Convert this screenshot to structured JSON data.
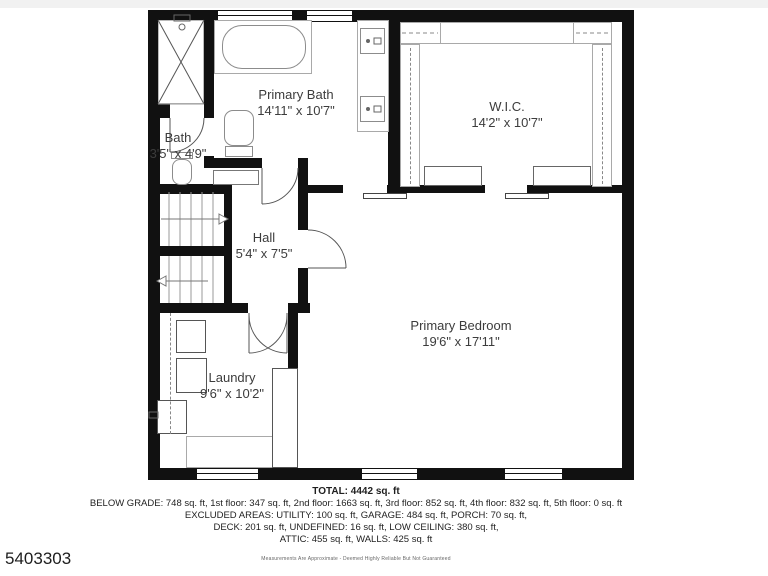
{
  "page": {
    "mls_number": "5403303"
  },
  "rooms": {
    "primary_bath": {
      "name": "Primary Bath",
      "dims": "14'11\" x 10'7\""
    },
    "bath": {
      "name": "Bath",
      "dims": "3'5\" x 4'9\""
    },
    "wic": {
      "name": "W.I.C.",
      "dims": "14'2\" x 10'7\""
    },
    "hall": {
      "name": "Hall",
      "dims": "5'4\" x 7'5\""
    },
    "primary_bedroom": {
      "name": "Primary Bedroom",
      "dims": "19'6\" x 17'11\""
    },
    "laundry": {
      "name": "Laundry",
      "dims": "9'6\" x 10'2\""
    }
  },
  "summary": {
    "total": "TOTAL: 4442 sq. ft",
    "line1": "BELOW GRADE: 748 sq. ft, 1st floor: 347 sq. ft, 2nd floor: 1663 sq. ft, 3rd floor: 852 sq. ft, 4th floor: 832 sq. ft, 5th floor: 0 sq. ft",
    "line2": "EXCLUDED AREAS: UTILITY: 100 sq. ft, GARAGE: 484 sq. ft, PORCH: 70 sq. ft,",
    "line3": "DECK: 201 sq. ft, UNDEFINED: 16 sq. ft, LOW CEILING: 380 sq. ft,",
    "line4": "ATTIC: 455 sq. ft, WALLS: 425 sq. ft",
    "disclaimer": "Measurements Are Approximate - Deemed Highly Reliable But Not Guaranteed"
  }
}
